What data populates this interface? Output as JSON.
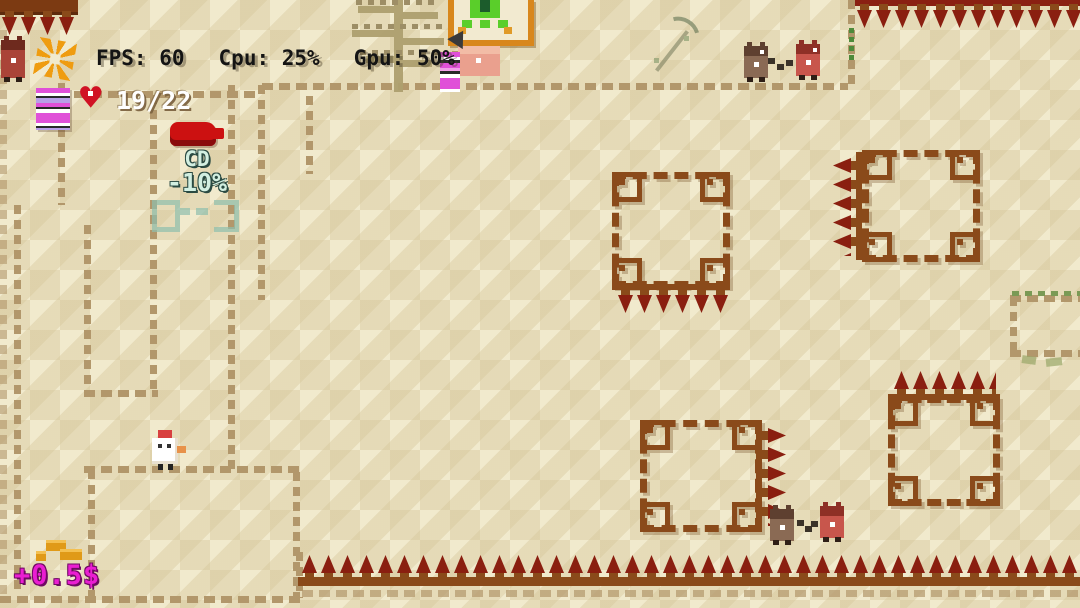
{
  "hud": {
    "fps_label": "FPS:",
    "fps_value": "60",
    "cpu_label": "Cpu:",
    "cpu_value": "25%",
    "gpu_label": "Gpu:",
    "gpu_value": "50%",
    "health_value": "19/22"
  },
  "pickups": {
    "cooldown_item": {
      "name": "CD",
      "effect": "-10%"
    },
    "money_gain": "+0.5$"
  },
  "icons": {
    "gear-icon": "orange pixel cog",
    "heart-icon": "red pixel heart",
    "item-books-icon": "pink striped book stack",
    "coin-icon": "gold coin bars",
    "arrow-indicator-icon": "dark arrow above merchant"
  },
  "colors": {
    "sand_light": "#f1eacd",
    "sand_dark": "#e4d9b0",
    "wall_tan": "#b2976b",
    "ornament_brown": "#8a4a1a",
    "spike_red": "#8a1f10",
    "portal_orange": "#d8871c",
    "portal_green": "#5ace2a",
    "hud_text": "#141414",
    "health_text": "#ffffff",
    "cd_text": "#d2efe1",
    "money_text": "#ea1ed2"
  }
}
